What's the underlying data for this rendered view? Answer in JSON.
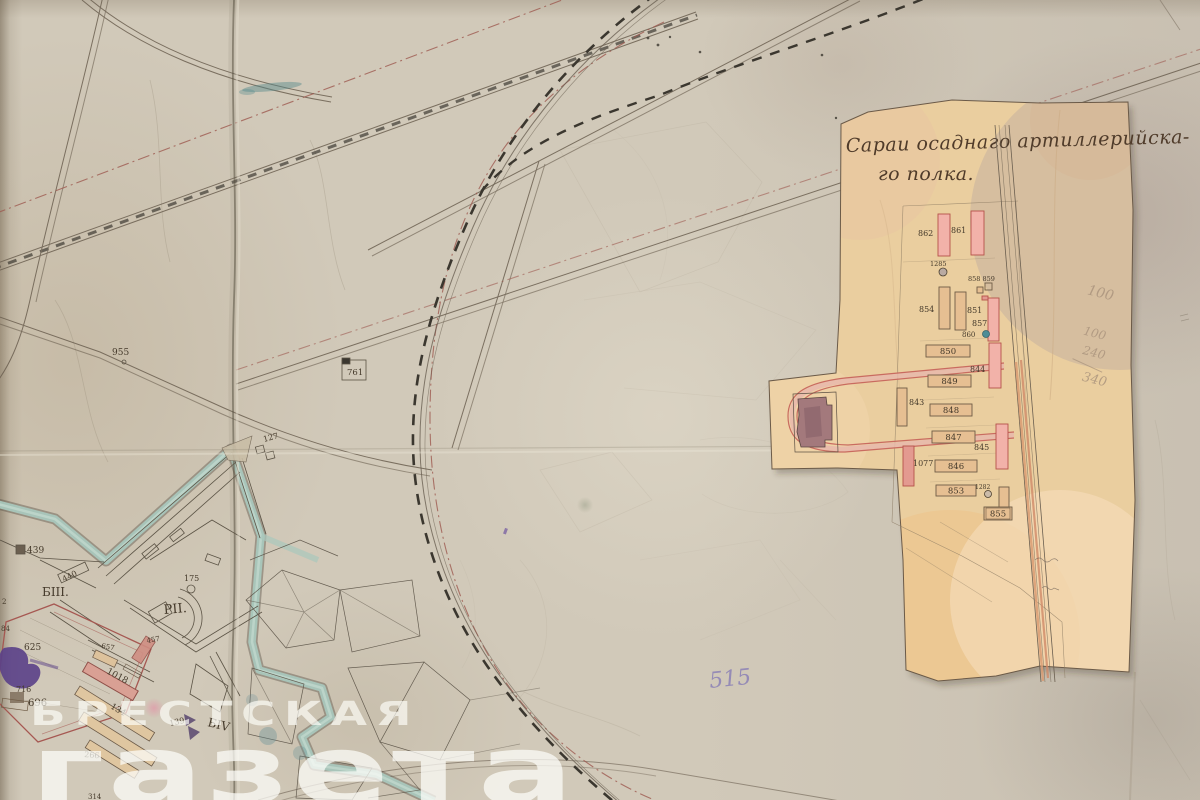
{
  "watermark": {
    "line1": "БРЕСТСКАЯ",
    "line2": "газета"
  },
  "inset": {
    "title_line1": "Сараи осаднаго артиллерийска-",
    "title_line2": "го полка.",
    "pencil_notes": [
      {
        "text": "100",
        "x": 1078,
        "y": 296,
        "size": 14
      },
      {
        "text": "100",
        "x": 1084,
        "y": 336,
        "size": 12
      },
      {
        "text": "240",
        "x": 1088,
        "y": 355,
        "size": 12
      },
      {
        "text": "340",
        "x": 1094,
        "y": 381,
        "size": 13
      }
    ],
    "labels": [
      {
        "text": "862",
        "x": 918,
        "y": 236,
        "size": 8
      },
      {
        "text": "861",
        "x": 951,
        "y": 233,
        "size": 8
      },
      {
        "text": "1285",
        "x": 930,
        "y": 266,
        "size": 6.5
      },
      {
        "text": "854",
        "x": 919,
        "y": 312,
        "size": 8
      },
      {
        "text": "851",
        "x": 967,
        "y": 313,
        "size": 8
      },
      {
        "text": "858 859",
        "x": 968,
        "y": 281,
        "size": 6.5
      },
      {
        "text": "857",
        "x": 972,
        "y": 326,
        "size": 8
      },
      {
        "text": "860",
        "x": 962,
        "y": 337,
        "size": 7
      },
      {
        "text": "844",
        "x": 970,
        "y": 372,
        "size": 8
      },
      {
        "text": "843",
        "x": 909,
        "y": 405,
        "size": 8
      },
      {
        "text": "845",
        "x": 974,
        "y": 450,
        "size": 8
      },
      {
        "text": "1077",
        "x": 913,
        "y": 466,
        "size": 8
      },
      {
        "text": "1282",
        "x": 975,
        "y": 489,
        "size": 6
      }
    ],
    "buildings": [
      {
        "label": "",
        "x": 938,
        "y": 214,
        "w": 12,
        "h": 42,
        "fill": "pink"
      },
      {
        "label": "",
        "x": 971,
        "y": 211,
        "w": 13,
        "h": 44,
        "fill": "pink"
      },
      {
        "label": "",
        "x": 939,
        "y": 287,
        "w": 11,
        "h": 42,
        "fill": "tan"
      },
      {
        "label": "",
        "x": 955,
        "y": 292,
        "w": 11,
        "h": 38,
        "fill": "tan"
      },
      {
        "label": "",
        "x": 988,
        "y": 298,
        "w": 11,
        "h": 43,
        "fill": "pink"
      },
      {
        "label": "",
        "x": 989,
        "y": 343,
        "w": 12,
        "h": 45,
        "fill": "pink"
      },
      {
        "label": "",
        "x": 897,
        "y": 388,
        "w": 10,
        "h": 38,
        "fill": "tan"
      },
      {
        "label": "",
        "x": 996,
        "y": 424,
        "w": 12,
        "h": 45,
        "fill": "pink"
      },
      {
        "label": "",
        "x": 903,
        "y": 446,
        "w": 11,
        "h": 40,
        "fill": "red"
      },
      {
        "label": "",
        "x": 977,
        "y": 287,
        "w": 6,
        "h": 6,
        "fill": "tan"
      },
      {
        "label": "",
        "x": 985,
        "y": 283,
        "w": 7,
        "h": 7,
        "fill": "none"
      },
      {
        "label": "",
        "x": 982,
        "y": 296,
        "w": 6,
        "h": 4,
        "fill": "red"
      },
      {
        "label": "850",
        "x": 926,
        "y": 345,
        "w": 44,
        "h": 12,
        "fill": "tan",
        "inside": true
      },
      {
        "label": "849",
        "x": 928,
        "y": 375,
        "w": 43,
        "h": 12,
        "fill": "tan",
        "inside": true
      },
      {
        "label": "848",
        "x": 930,
        "y": 404,
        "w": 42,
        "h": 12,
        "fill": "tan",
        "inside": true
      },
      {
        "label": "847",
        "x": 932,
        "y": 431,
        "w": 43,
        "h": 12,
        "fill": "tan",
        "inside": true
      },
      {
        "label": "846",
        "x": 935,
        "y": 460,
        "w": 42,
        "h": 12,
        "fill": "tan",
        "inside": true
      },
      {
        "label": "853",
        "x": 936,
        "y": 485,
        "w": 40,
        "h": 11,
        "fill": "tan",
        "inside": true
      },
      {
        "label": "",
        "x": 999,
        "y": 487,
        "w": 10,
        "h": 22,
        "fill": "tan"
      },
      {
        "label": "855",
        "x": 984,
        "y": 507,
        "w": 28,
        "h": 13,
        "fill": "tan",
        "inside": true,
        "boxed": true
      }
    ],
    "markers": [
      {
        "x": 943,
        "y": 272,
        "r": 4,
        "fill": "#b9aaa2",
        "stroke": "#4a3f30"
      },
      {
        "x": 986,
        "y": 334,
        "r": 3.5,
        "fill": "#4f8d96",
        "stroke": "#37636b"
      },
      {
        "x": 988,
        "y": 494,
        "r": 3.5,
        "fill": "#cbbba9",
        "stroke": "#4a3f30"
      }
    ],
    "colors": {
      "pink": "#f2b2a9",
      "pink_stroke": "#b5524a",
      "tan": "#e6bf92",
      "tan_stroke": "#6f5c46",
      "red": "#e39a90",
      "none": "none"
    }
  },
  "map": {
    "labels": [
      {
        "text": "955",
        "x": 112,
        "y": 355,
        "size": 9
      },
      {
        "text": "761",
        "x": 347,
        "y": 375,
        "size": 8.5
      },
      {
        "text": "127",
        "x": 264,
        "y": 442,
        "size": 8,
        "rot": -15
      },
      {
        "text": "439",
        "x": 27,
        "y": 553,
        "size": 9
      },
      {
        "text": "440",
        "x": 64,
        "y": 582,
        "size": 8,
        "rot": -27
      },
      {
        "text": "БIII.",
        "x": 42,
        "y": 596,
        "size": 12
      },
      {
        "text": "175",
        "x": 184,
        "y": 581,
        "size": 8
      },
      {
        "text": "РII.",
        "x": 164,
        "y": 614,
        "size": 13,
        "rot": -5
      },
      {
        "text": "657",
        "x": 101,
        "y": 648,
        "size": 7,
        "rot": 10
      },
      {
        "text": "457",
        "x": 147,
        "y": 643,
        "size": 7,
        "rot": -10
      },
      {
        "text": "625",
        "x": 24,
        "y": 650,
        "size": 9
      },
      {
        "text": "716",
        "x": 16,
        "y": 692,
        "size": 8
      },
      {
        "text": "696",
        "x": 28,
        "y": 706,
        "size": 10
      },
      {
        "text": "1018",
        "x": 106,
        "y": 673,
        "size": 9,
        "rot": 28
      },
      {
        "text": "134",
        "x": 110,
        "y": 708,
        "size": 8.5,
        "rot": 30
      },
      {
        "text": "139",
        "x": 170,
        "y": 726,
        "size": 8,
        "rot": -12
      },
      {
        "text": "БIV",
        "x": 207,
        "y": 726,
        "size": 12,
        "rot": 14
      },
      {
        "text": "266",
        "x": 84,
        "y": 757,
        "size": 8,
        "rot": 5
      },
      {
        "text": "314",
        "x": 88,
        "y": 799,
        "size": 7
      },
      {
        "text": "2",
        "x": 2,
        "y": 604,
        "size": 7
      },
      {
        "text": "84",
        "x": 1,
        "y": 631,
        "size": 7
      }
    ],
    "purple_note": {
      "text": "515",
      "x": 710,
      "y": 688,
      "size": 22,
      "color": "#8b80b6"
    }
  },
  "colors": {
    "paper": "#d1c9b9",
    "patch": "#eace9f",
    "moat_teal": "#a9c7bc",
    "line_ink": "#5b5345",
    "rail_dash": "#3b372f",
    "red_dashdot": "#9e5a50",
    "hand_ink": "#4f3b2a",
    "pencil": "#a8927c",
    "watermark": "rgba(253,253,247,0.78)",
    "purple_blot": "#5a4088"
  }
}
